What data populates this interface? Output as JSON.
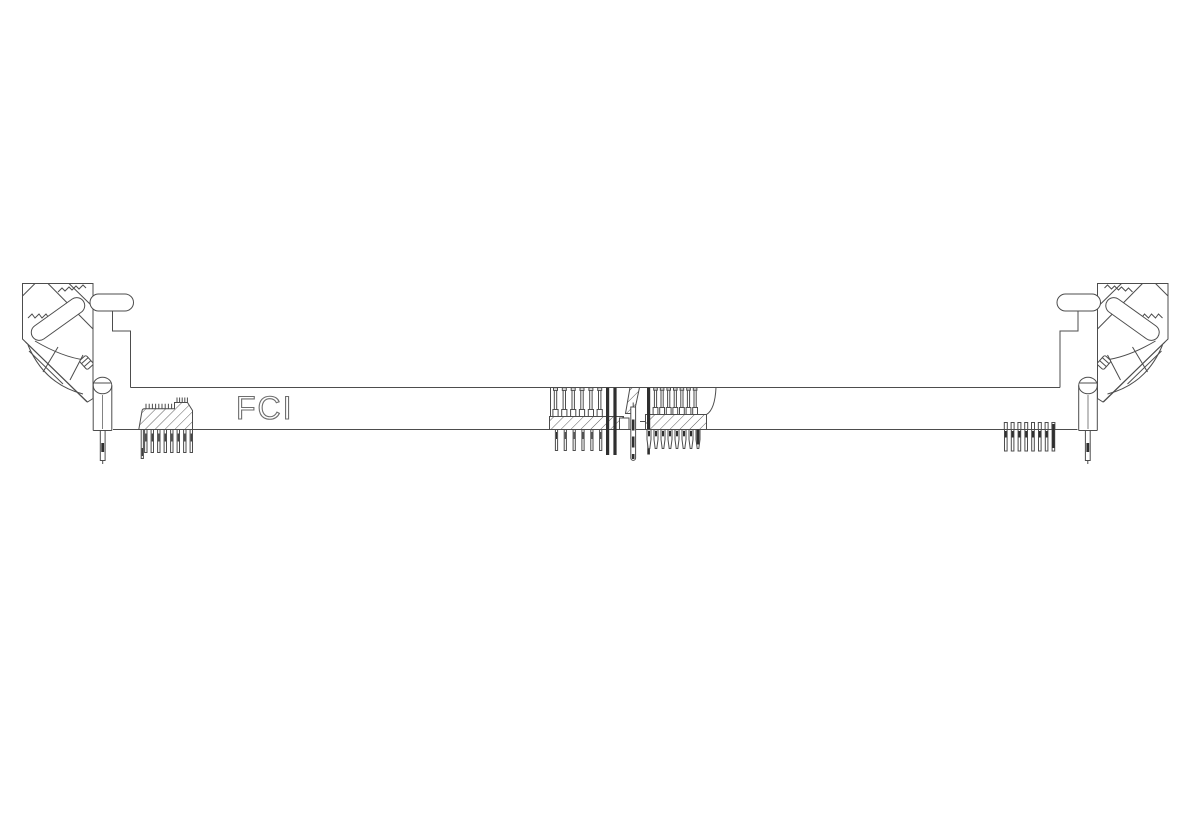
{
  "figure": {
    "brand_label": "FCI",
    "description": "technical-line-drawing-dimm-socket-connector-side-view",
    "features": {
      "left_pin_header_pin_count": 9,
      "right_pin_row_pin_count": 8,
      "center_left_contact_count": 8,
      "center_right_contact_count": 8,
      "ejector_latch_count": 2
    }
  },
  "colors": {
    "background": "#ffffff",
    "line": "#4d4d4d",
    "dark_fill": "#2f2f2f",
    "brand_outline": "#6e6e6e"
  }
}
